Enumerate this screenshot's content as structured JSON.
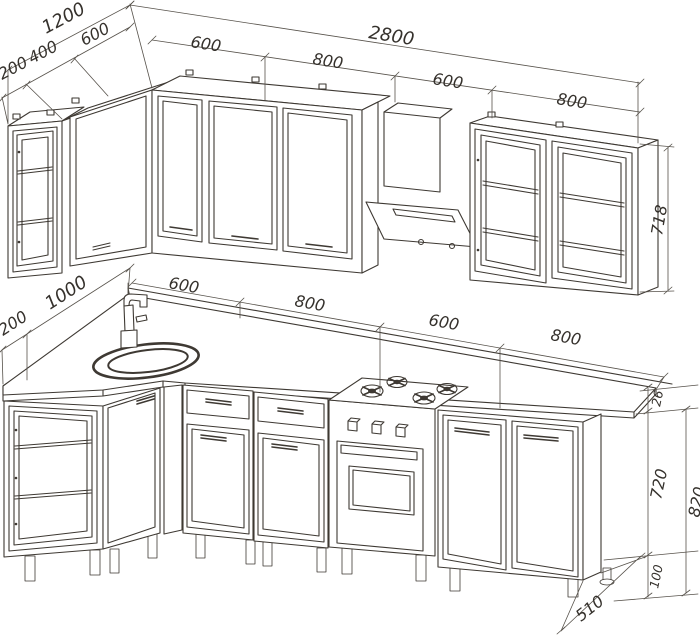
{
  "drawing": {
    "type": "kitchen-corner-set-isometric-technical-drawing",
    "upper_row": {
      "depth_total": "1200",
      "depth_segments": [
        "200",
        "400",
        "600"
      ],
      "width_total": "2800",
      "width_segments": [
        "600",
        "800",
        "600",
        "800"
      ],
      "cabinet_height": "718"
    },
    "lower_row": {
      "left_end_width": "200",
      "left_wall_run": "1000",
      "width_segments": [
        "600",
        "800",
        "600",
        "800"
      ],
      "worktop_thickness": "26",
      "base_cabinet_height": "720",
      "leg_height": "100",
      "total_height": "820",
      "base_depth": "510"
    }
  }
}
